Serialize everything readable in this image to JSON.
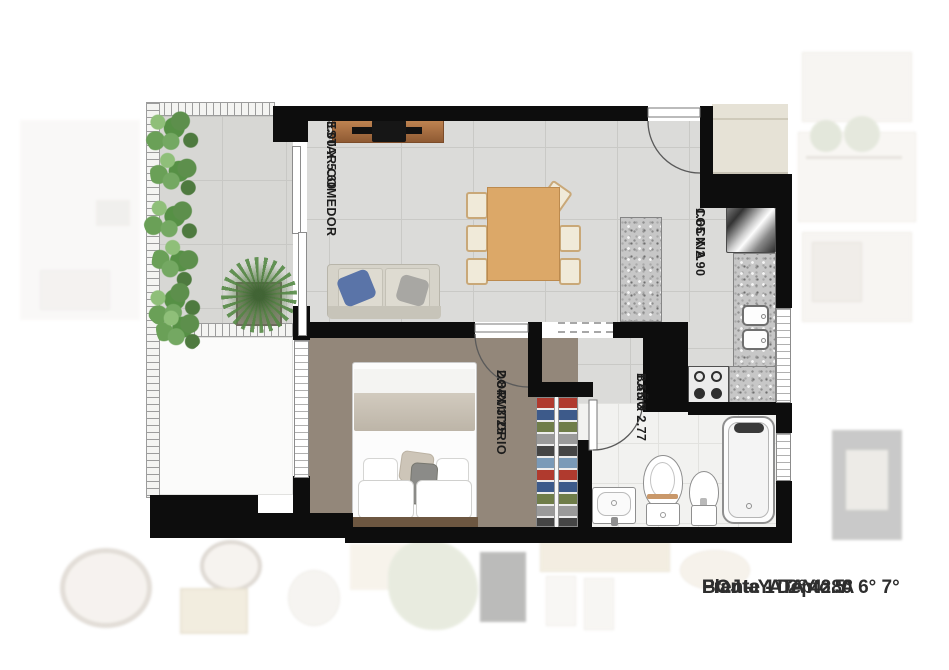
{
  "plan": {
    "rooms": [
      {
        "name": "ESTAR COMEDOR",
        "dims": "3.00 X 5.60"
      },
      {
        "name": "COCINA",
        "dims": "1.65 X 2.90"
      },
      {
        "name": "DORMITORIO",
        "dims": "2.84X 3.25"
      },
      {
        "name": "BAÑO",
        "dims": "1.55 X 2.77"
      }
    ]
  },
  "caption": {
    "lines": [
      "Planta 1° 2° 4° 5° 6° 7°",
      "Frente - Depto. A",
      "BOJ - YATAY 280"
    ]
  },
  "colors": {
    "wall": "#0d0d0d",
    "tile_floor": "#dbdbd9",
    "wood_floor": "#93877a",
    "granite": "#c7c7c7",
    "plant_green": "#5d8f4c",
    "entry_landing": "#e6e2d6",
    "caption_text": "#2e2e2e"
  }
}
